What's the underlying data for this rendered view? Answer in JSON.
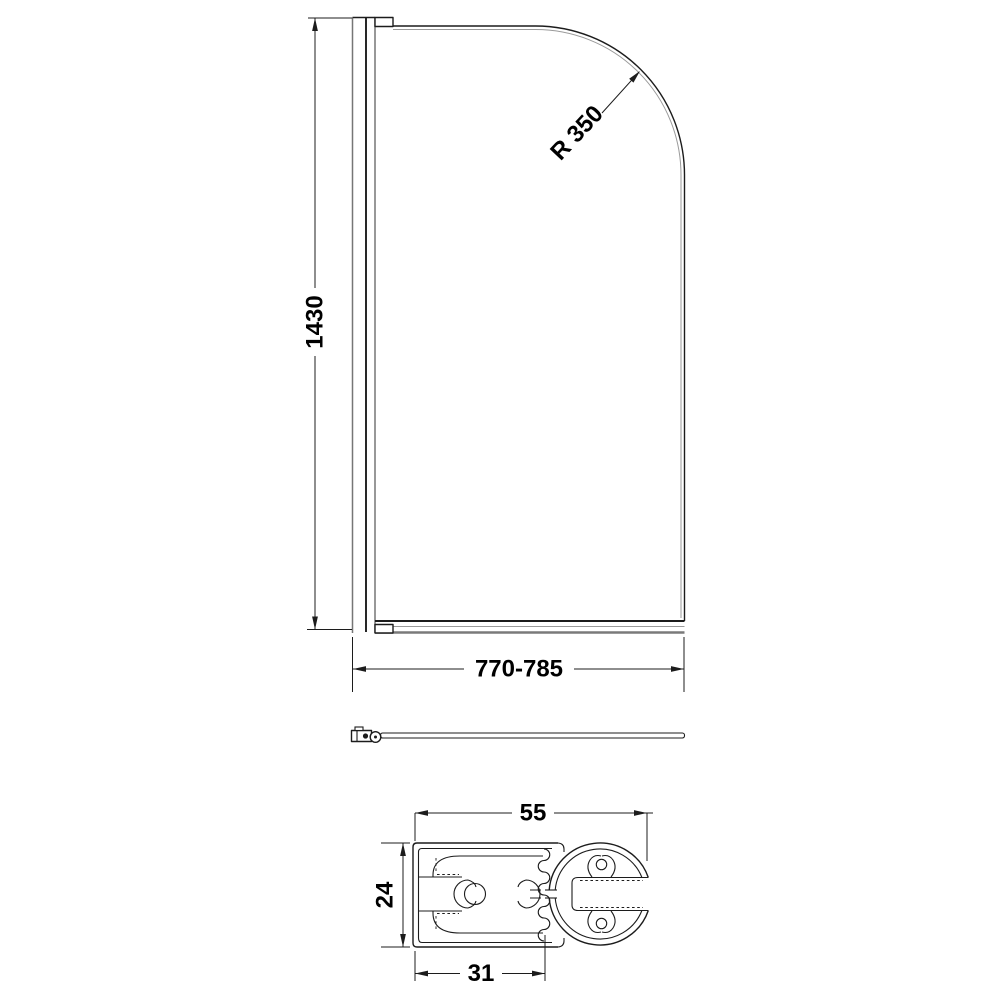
{
  "drawing": {
    "background_color": "#ffffff",
    "line_color": "#1c1c1c",
    "front_view": {
      "height_label": "1430",
      "radius_label": "R 350",
      "width_label": "770-785"
    },
    "section_view": {
      "overall_width_label": "55",
      "profile_depth_label": "24",
      "channel_width_label": "31"
    }
  }
}
